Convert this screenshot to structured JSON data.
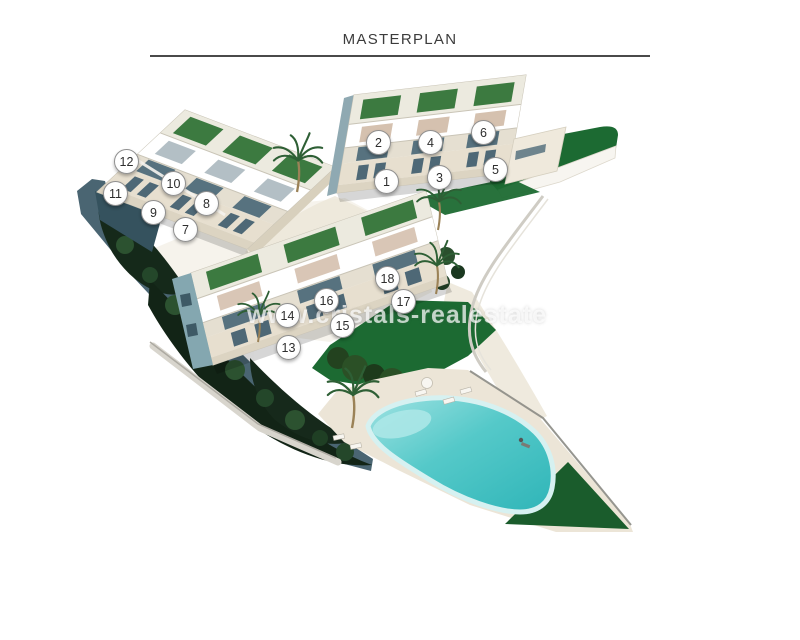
{
  "header": {
    "title": "MASTERPLAN"
  },
  "watermark": {
    "text": "www.cristals-realestate"
  },
  "masterplan": {
    "description": "aerial-3d-site-plan",
    "unit_markers": [
      {
        "label": "1"
      },
      {
        "label": "2"
      },
      {
        "label": "3"
      },
      {
        "label": "4"
      },
      {
        "label": "5"
      },
      {
        "label": "6"
      },
      {
        "label": "7"
      },
      {
        "label": "8"
      },
      {
        "label": "9"
      },
      {
        "label": "10"
      },
      {
        "label": "11"
      },
      {
        "label": "12"
      },
      {
        "label": "13"
      },
      {
        "label": "14"
      },
      {
        "label": "15"
      },
      {
        "label": "16"
      },
      {
        "label": "17"
      },
      {
        "label": "18"
      }
    ]
  },
  "colors": {
    "lawn": "#1c6a32",
    "lawn_dark": "#1a5c2c",
    "pool": "#4cc5c7",
    "pool_rim": "#d6f1f1",
    "pool_deck": "#ece5d7",
    "cliff": "#4a6572",
    "trees_dark": "#14271a",
    "roof_garden": "#3c7a40",
    "facade": "#f6f4ef",
    "glass": "#57727f",
    "title_text": "#3c3c3c",
    "marker_border": "#8f8f8f"
  }
}
